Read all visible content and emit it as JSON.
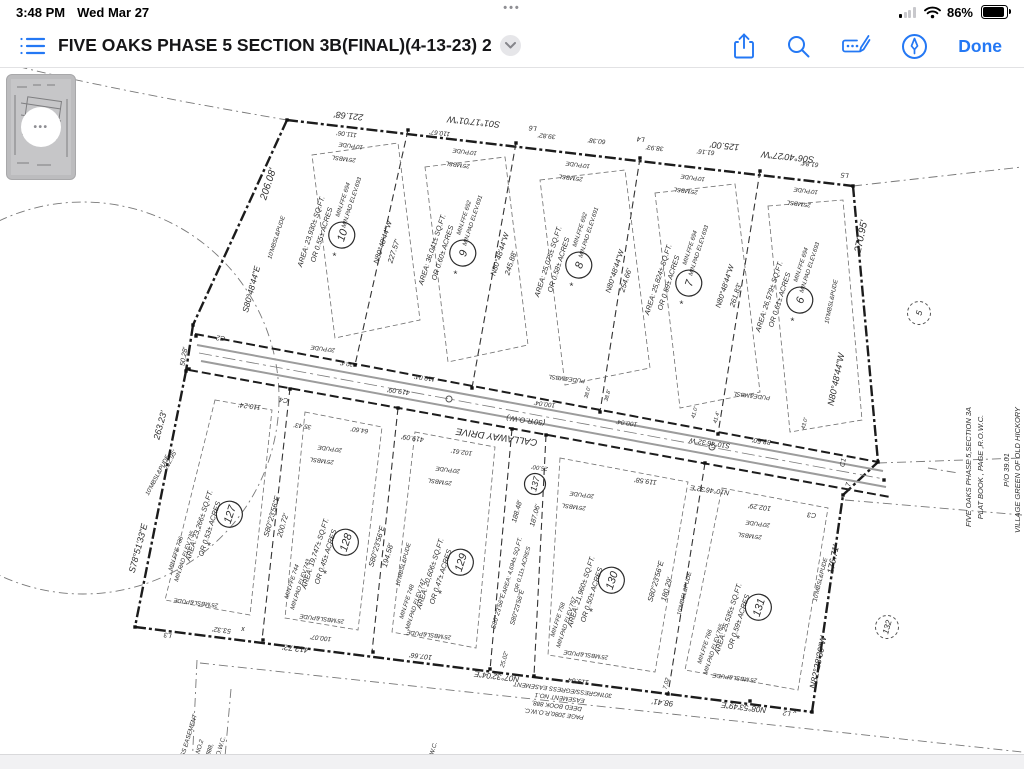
{
  "status_bar": {
    "time": "3:48 PM",
    "date": "Wed Mar 27",
    "battery_pct": "86%",
    "multitask_dots": "•••"
  },
  "toolbar": {
    "title": "FIVE OAKS PHASE 5 SECTION 3B(FINAL)(4-13-23) 2",
    "done_label": "Done",
    "icons": [
      "thumbnails-icon",
      "share-icon",
      "search-icon",
      "markup-icon",
      "pen-circle-icon"
    ]
  },
  "thumbnail": {
    "dots": "•••"
  },
  "plat": {
    "road": {
      "name": "CALLAWAY DRIVE",
      "row": "(50'R.O.W.)"
    },
    "lots_top": [
      {
        "num": "10",
        "cx": 319,
        "cy": 234,
        "area1": "AREA: 23,930± SQ.FT.",
        "area2": "OR 0.55± ACRES",
        "ffe": "MIN.FFE 694",
        "pad": "MIN.PAD ELEV.693"
      },
      {
        "num": "9",
        "cx": 440,
        "cy": 252,
        "area1": "AREA: 36,041± SQ.FT.",
        "area2": "OR 0.60± ACRES",
        "ffe": "MIN.FFE 692",
        "pad": "MIN.PAD ELEV.691"
      },
      {
        "num": "8",
        "cx": 556,
        "cy": 264,
        "area1": "AREA: 25,075± SQ.FT.",
        "area2": "OR 0.58± ACRES",
        "ffe": "MIN.FFE 692",
        "pad": "MIN.PAD ELEV.691"
      },
      {
        "num": "7",
        "cx": 666,
        "cy": 282,
        "area1": "AREA: 25,824± SQ.FT.",
        "area2": "OR 0.59± ACRES",
        "ffe": "MIN.FFE 694",
        "pad": "MIN.PAD ELEV.693"
      },
      {
        "num": "6",
        "cx": 777,
        "cy": 299,
        "area1": "AREA: 26,579± SQ.FT.",
        "area2": "OR 0.61± ACRES",
        "ffe": "MIN.FFE 694",
        "pad": "MIN.PAD ELEV.693"
      }
    ],
    "lots_bottom": [
      {
        "num": "127",
        "cx": 207,
        "cy": 528,
        "area1": "AREA: 23,266± SQ.FT.",
        "area2": "OR 0.53± ACRES",
        "ffe": "MIN.FFE 736",
        "pad": "MIN.PAD ELEV.735"
      },
      {
        "num": "128",
        "cx": 323,
        "cy": 556,
        "area1": "AREA: 19,747± SQ.FT.",
        "area2": "OR 0.45± ACRES",
        "ffe": "MIN.FFE 744",
        "pad": "MIN.PAD ELEV.743"
      },
      {
        "num": "129",
        "cx": 438,
        "cy": 576,
        "area1": "AREA: 20,606± SQ.FT.",
        "area2": "OR 0.47± ACRES",
        "ffe": "MIN.FFE 748",
        "pad": "MIN.PAD ELEV.747"
      },
      {
        "num": "130",
        "cx": 589,
        "cy": 594,
        "area1": "AREA: 21,960± SQ.FT.",
        "area2": "OR 0.50± ACRES",
        "ffe": "MIN.FFE 758",
        "pad": "MIN.PAD ELEV.757"
      },
      {
        "num": "131",
        "cx": 736,
        "cy": 621,
        "area1": "AREA: 25,535± SQ.FT.",
        "area2": "OR 0.59± ACRES",
        "ffe": "MIN.FFE 766",
        "pad": "MIN.PAD ELEV.765"
      }
    ],
    "strip": {
      "num": "137",
      "x": 535,
      "y": 484
    },
    "adjacent": [
      {
        "num": "5",
        "x": 919,
        "y": 313
      },
      {
        "num": "132",
        "x": 887,
        "y": 627
      }
    ],
    "labels": [
      {
        "t": "221.68'",
        "x": 349,
        "y": 113,
        "r": 186,
        "s": 9
      },
      {
        "t": "S01°17'01\"W",
        "x": 474,
        "y": 119,
        "r": 186,
        "s": 9
      },
      {
        "t": "110.67'",
        "x": 440,
        "y": 131,
        "r": 186,
        "s": 6.5
      },
      {
        "t": "L6",
        "x": 533,
        "y": 126,
        "r": 186,
        "s": 7
      },
      {
        "t": "39.82'",
        "x": 547,
        "y": 134,
        "r": 186,
        "s": 6.5
      },
      {
        "t": "60.38'",
        "x": 597,
        "y": 139,
        "r": 186,
        "s": 6.5
      },
      {
        "t": "L4",
        "x": 641,
        "y": 137,
        "r": 186,
        "s": 7
      },
      {
        "t": "38.93'",
        "x": 655,
        "y": 146,
        "r": 186,
        "s": 6.5
      },
      {
        "t": "61.16'",
        "x": 706,
        "y": 150,
        "r": 186,
        "s": 6.5
      },
      {
        "t": "125.00'",
        "x": 725,
        "y": 143,
        "r": 186,
        "s": 9
      },
      {
        "t": "S06°40'27\"W",
        "x": 788,
        "y": 154,
        "r": 186,
        "s": 9
      },
      {
        "t": "61.84'",
        "x": 810,
        "y": 162,
        "r": 186,
        "s": 6.5
      },
      {
        "t": "L5",
        "x": 845,
        "y": 173,
        "r": 186,
        "s": 7
      },
      {
        "t": "270.95'",
        "x": 864,
        "y": 237,
        "r": -78,
        "s": 10
      },
      {
        "t": "N80°48'44\"W",
        "x": 839,
        "y": 380,
        "r": -78,
        "s": 9
      },
      {
        "t": "C1",
        "x": 845,
        "y": 463,
        "r": -78,
        "s": 7
      },
      {
        "t": "L7",
        "x": 850,
        "y": 487,
        "r": -78,
        "s": 7
      },
      {
        "t": "176.71'",
        "x": 836,
        "y": 560,
        "r": -78,
        "s": 9
      },
      {
        "t": "N82°28'30\"W",
        "x": 821,
        "y": 663,
        "r": -78,
        "s": 9
      },
      {
        "t": "206.08'",
        "x": 271,
        "y": 185,
        "r": -72,
        "s": 10
      },
      {
        "t": "10'MBSL&PUDE",
        "x": 278,
        "y": 238,
        "r": -72,
        "s": 6
      },
      {
        "t": "S80°48'44\"E",
        "x": 254,
        "y": 290,
        "r": -75,
        "s": 8.5
      },
      {
        "t": "50.28'",
        "x": 186,
        "y": 357,
        "r": -80,
        "s": 7
      },
      {
        "t": "S78°51'33\"E",
        "x": 141,
        "y": 549,
        "r": -75,
        "s": 9
      },
      {
        "t": "263.23'",
        "x": 163,
        "y": 426,
        "r": -75,
        "s": 9
      },
      {
        "t": "L3",
        "x": 168,
        "y": 633,
        "r": 187,
        "s": 7
      },
      {
        "t": "53.32'",
        "x": 222,
        "y": 628,
        "r": 187,
        "s": 7
      },
      {
        "t": "412.72'",
        "x": 296,
        "y": 646,
        "r": 187,
        "s": 8
      },
      {
        "t": "100.07'",
        "x": 321,
        "y": 636,
        "r": 187,
        "s": 6.5
      },
      {
        "t": "107.66'",
        "x": 421,
        "y": 654,
        "r": 187,
        "s": 7
      },
      {
        "t": "25.02'",
        "x": 506,
        "y": 660,
        "r": -75,
        "s": 6
      },
      {
        "t": "N07°32'04\"E",
        "x": 497,
        "y": 674,
        "r": 187,
        "s": 8
      },
      {
        "t": "119.64'",
        "x": 578,
        "y": 679,
        "r": 187,
        "s": 7
      },
      {
        "t": "7.02",
        "x": 668,
        "y": 684,
        "r": -75,
        "s": 6
      },
      {
        "t": "98.41'",
        "x": 663,
        "y": 700,
        "r": 187,
        "s": 8
      },
      {
        "t": "N08°53'49\"E",
        "x": 744,
        "y": 705,
        "r": 187,
        "s": 8
      },
      {
        "t": "L2",
        "x": 787,
        "y": 711,
        "r": 187,
        "s": 7
      },
      {
        "t": "C2",
        "x": 221,
        "y": 336,
        "r": 187,
        "s": 7
      },
      {
        "t": "110.24'",
        "x": 250,
        "y": 404,
        "r": 187,
        "s": 7
      },
      {
        "t": "C4",
        "x": 284,
        "y": 398,
        "r": 187,
        "s": 7
      },
      {
        "t": "20.4'",
        "x": 347,
        "y": 362,
        "r": 187,
        "s": 6
      },
      {
        "t": "419.09'",
        "x": 399,
        "y": 389,
        "r": 188,
        "s": 7
      },
      {
        "t": "110.04'",
        "x": 425,
        "y": 376,
        "r": 188,
        "s": 6.5
      },
      {
        "t": "35.43'",
        "x": 303,
        "y": 424,
        "r": 188,
        "s": 6.5
      },
      {
        "t": "64.60'",
        "x": 360,
        "y": 428,
        "r": 188,
        "s": 6.5
      },
      {
        "t": "419.09'",
        "x": 413,
        "y": 436,
        "r": 188,
        "s": 7
      },
      {
        "t": "102.61'",
        "x": 462,
        "y": 450,
        "r": 188,
        "s": 6.5
      },
      {
        "t": "(50'R.O.W.)",
        "x": 526,
        "y": 418,
        "r": 188,
        "s": 7.5
      },
      {
        "t": "CALLAWAY DRIVE",
        "x": 497,
        "y": 434,
        "r": 188,
        "s": 9.5
      },
      {
        "t": "100.04'",
        "x": 545,
        "y": 402,
        "r": 188,
        "s": 6.5
      },
      {
        "t": "100.04'",
        "x": 627,
        "y": 421,
        "r": 188,
        "s": 6.5
      },
      {
        "t": "25.00'",
        "x": 540,
        "y": 466,
        "r": 188,
        "s": 6
      },
      {
        "t": "S10°46'32\"W",
        "x": 710,
        "y": 441,
        "r": 188,
        "s": 7
      },
      {
        "t": "88.50'",
        "x": 762,
        "y": 439,
        "r": 188,
        "s": 7
      },
      {
        "t": "119.58'",
        "x": 646,
        "y": 479,
        "r": 188,
        "s": 7
      },
      {
        "t": "N10°46'32\"E",
        "x": 710,
        "y": 488,
        "r": 188,
        "s": 7
      },
      {
        "t": "102.29'",
        "x": 760,
        "y": 505,
        "r": 188,
        "s": 7
      },
      {
        "t": "C3",
        "x": 812,
        "y": 513,
        "r": 187,
        "s": 7
      },
      {
        "t": "111.06'",
        "x": 347,
        "y": 132,
        "r": 187,
        "s": 6.5
      },
      {
        "t": "10'PUDE",
        "x": 351,
        "y": 144,
        "r": 187,
        "s": 6
      },
      {
        "t": "25'MBSL",
        "x": 344,
        "y": 157,
        "r": 187,
        "s": 6
      },
      {
        "t": "10'PUDE",
        "x": 465,
        "y": 150,
        "r": 187,
        "s": 6
      },
      {
        "t": "25'MBSL",
        "x": 458,
        "y": 163,
        "r": 187,
        "s": 6
      },
      {
        "t": "10'PUDE",
        "x": 578,
        "y": 163,
        "r": 187,
        "s": 6
      },
      {
        "t": "25'MBSL",
        "x": 571,
        "y": 176,
        "r": 187,
        "s": 6
      },
      {
        "t": "10'PUDE",
        "x": 693,
        "y": 176,
        "r": 187,
        "s": 6
      },
      {
        "t": "25'MBSL",
        "x": 686,
        "y": 189,
        "r": 187,
        "s": 6
      },
      {
        "t": "10'PUDE",
        "x": 806,
        "y": 189,
        "r": 187,
        "s": 6
      },
      {
        "t": "25'MBSL",
        "x": 799,
        "y": 202,
        "r": 187,
        "s": 6
      },
      {
        "t": "N80°48'44\"W",
        "x": 385,
        "y": 243,
        "r": -72,
        "s": 7.5
      },
      {
        "t": "227.57'",
        "x": 396,
        "y": 252,
        "r": -72,
        "s": 7.5
      },
      {
        "t": "N80°48'44\"W",
        "x": 502,
        "y": 255,
        "r": -72,
        "s": 7.5
      },
      {
        "t": "245.88'",
        "x": 513,
        "y": 264,
        "r": -72,
        "s": 7.5
      },
      {
        "t": "N80°48'44\"W",
        "x": 617,
        "y": 272,
        "r": -72,
        "s": 7.5
      },
      {
        "t": "254.66'",
        "x": 628,
        "y": 281,
        "r": -72,
        "s": 7.5
      },
      {
        "t": "N80°48'44\"W",
        "x": 727,
        "y": 287,
        "r": -72,
        "s": 7.5
      },
      {
        "t": "261.83'",
        "x": 738,
        "y": 296,
        "r": -72,
        "s": 7.5
      },
      {
        "t": "10'MBSL&PUDE",
        "x": 833,
        "y": 302,
        "r": -78,
        "s": 6
      },
      {
        "t": "S80°23'56\"E",
        "x": 274,
        "y": 517,
        "r": -74,
        "s": 7.5
      },
      {
        "t": "200.72'",
        "x": 285,
        "y": 526,
        "r": -74,
        "s": 7.5
      },
      {
        "t": "S80°23'56\"E",
        "x": 379,
        "y": 547,
        "r": -74,
        "s": 7.5
      },
      {
        "t": "194.58'",
        "x": 390,
        "y": 556,
        "r": -74,
        "s": 7.5
      },
      {
        "t": "S80°23'56\"E",
        "x": 500,
        "y": 612,
        "r": -74,
        "s": 6.5
      },
      {
        "t": "S80°23'56\"E",
        "x": 519,
        "y": 608,
        "r": -74,
        "s": 6.5
      },
      {
        "t": "188.48'",
        "x": 519,
        "y": 512,
        "r": -74,
        "s": 7
      },
      {
        "t": "187.06'",
        "x": 537,
        "y": 516,
        "r": -74,
        "s": 7
      },
      {
        "t": "AREA: 4,694± SQ.FT.",
        "x": 514,
        "y": 566,
        "r": -74,
        "s": 6
      },
      {
        "t": "OR 0.11± ACRES",
        "x": 524,
        "y": 570,
        "r": -74,
        "s": 6
      },
      {
        "t": "S80°23'56\"E",
        "x": 658,
        "y": 582,
        "r": -74,
        "s": 7.5
      },
      {
        "t": "180.29'",
        "x": 669,
        "y": 590,
        "r": -74,
        "s": 7.5
      },
      {
        "t": "10'MBSL&PUDE",
        "x": 686,
        "y": 594,
        "r": -76,
        "s": 6
      },
      {
        "t": "10'MBSL&PUDE",
        "x": 822,
        "y": 580,
        "r": -76,
        "s": 6
      },
      {
        "t": "10'MBSL&PUDE",
        "x": 405,
        "y": 565,
        "r": -75,
        "s": 6
      },
      {
        "t": "10'MBSL&PUDE",
        "x": 159,
        "y": 476,
        "r": -62,
        "s": 6
      },
      {
        "t": "212.95'",
        "x": 172,
        "y": 461,
        "r": -62,
        "s": 6.5
      },
      {
        "t": "20'PUDE",
        "x": 330,
        "y": 447,
        "r": 187,
        "s": 6
      },
      {
        "t": "25'MBSL",
        "x": 322,
        "y": 459,
        "r": 187,
        "s": 6
      },
      {
        "t": "20'PUDE",
        "x": 448,
        "y": 468,
        "r": 187,
        "s": 6
      },
      {
        "t": "25'MBSL",
        "x": 440,
        "y": 480,
        "r": 187,
        "s": 6
      },
      {
        "t": "20'PUDE",
        "x": 582,
        "y": 493,
        "r": 187,
        "s": 6
      },
      {
        "t": "25'MBSL",
        "x": 574,
        "y": 505,
        "r": 187,
        "s": 6
      },
      {
        "t": "20'PUDE",
        "x": 758,
        "y": 522,
        "r": 187,
        "s": 6
      },
      {
        "t": "25'MBSL",
        "x": 750,
        "y": 534,
        "r": 187,
        "s": 6
      },
      {
        "t": "25'MBSL&PUDE",
        "x": 196,
        "y": 601,
        "r": 187,
        "s": 6
      },
      {
        "t": "25'MBSL&PUDE",
        "x": 322,
        "y": 617,
        "r": 187,
        "s": 6
      },
      {
        "t": "25'MBSL&PUDE",
        "x": 429,
        "y": 633,
        "r": 187,
        "s": 6
      },
      {
        "t": "25'MBSL&PUDE",
        "x": 586,
        "y": 653,
        "r": 187,
        "s": 6
      },
      {
        "t": "25'MBSL&PUDE",
        "x": 735,
        "y": 676,
        "r": 187,
        "s": 6
      },
      {
        "t": "20'PUDE",
        "x": 323,
        "y": 347,
        "r": 187,
        "s": 6
      },
      {
        "t": "PUDE&MBSL",
        "x": 567,
        "y": 377,
        "r": 187,
        "s": 6
      },
      {
        "t": "PUDE&MBSL",
        "x": 752,
        "y": 394,
        "r": 187,
        "s": 6
      },
      {
        "t": "38.0'",
        "x": 589,
        "y": 393,
        "r": -75,
        "s": 5.5
      },
      {
        "t": "38.8'",
        "x": 609,
        "y": 396,
        "r": -75,
        "s": 5.5
      },
      {
        "t": "41.0'",
        "x": 696,
        "y": 413,
        "r": -75,
        "s": 5.5
      },
      {
        "t": "41.4'",
        "x": 718,
        "y": 418,
        "r": -75,
        "s": 5.5
      },
      {
        "t": "43.0'",
        "x": 806,
        "y": 424,
        "r": -75,
        "s": 5.5
      },
      {
        "t": "FIVE OAKS PHASE 5,SECTION 3A",
        "x": 971,
        "y": 467,
        "r": -90,
        "s": 7.5
      },
      {
        "t": "PLAT BOOK      , PAGE      ,R.O.W.C.",
        "x": 983,
        "y": 467,
        "r": -90,
        "s": 7.5
      },
      {
        "t": "P/O 39.01",
        "x": 1009,
        "y": 470,
        "r": -90,
        "s": 7.5
      },
      {
        "t": "VILLAGE GREEN OF OLD HICKORY",
        "x": 1020,
        "y": 470,
        "r": -90,
        "s": 7.5
      },
      {
        "t": "30'INGRESS/EGRESS EASEMENT",
        "x": 563,
        "y": 688,
        "r": 187,
        "s": 6.2
      },
      {
        "t": "EASEMENT NO.1",
        "x": 560,
        "y": 696,
        "r": 187,
        "s": 6.2
      },
      {
        "t": "DEED BOOK 888,",
        "x": 557,
        "y": 704,
        "r": 187,
        "s": 6.2
      },
      {
        "t": "PAGE 2080,R.O.W.C.",
        "x": 554,
        "y": 712,
        "r": 187,
        "s": 6.2
      },
      {
        "t": "ESS EASEMENT",
        "x": 190,
        "y": 738,
        "r": -73,
        "s": 6.2
      },
      {
        "t": "NT NO.2",
        "x": 200,
        "y": 752,
        "r": -73,
        "s": 6.2
      },
      {
        "t": "OK 888,",
        "x": 210,
        "y": 755,
        "r": -73,
        "s": 6.2
      },
      {
        "t": "0,R.O.W.C.",
        "x": 221,
        "y": 752,
        "r": -73,
        "s": 6.2
      },
      {
        "t": ".O.W.C.",
        "x": 434,
        "y": 753,
        "r": -73,
        "s": 6.2
      },
      {
        "t": "x",
        "x": 243,
        "y": 631,
        "r": 0,
        "s": 7
      },
      {
        "t": "x",
        "x": 795,
        "y": 713,
        "r": 0,
        "s": 7
      }
    ]
  }
}
